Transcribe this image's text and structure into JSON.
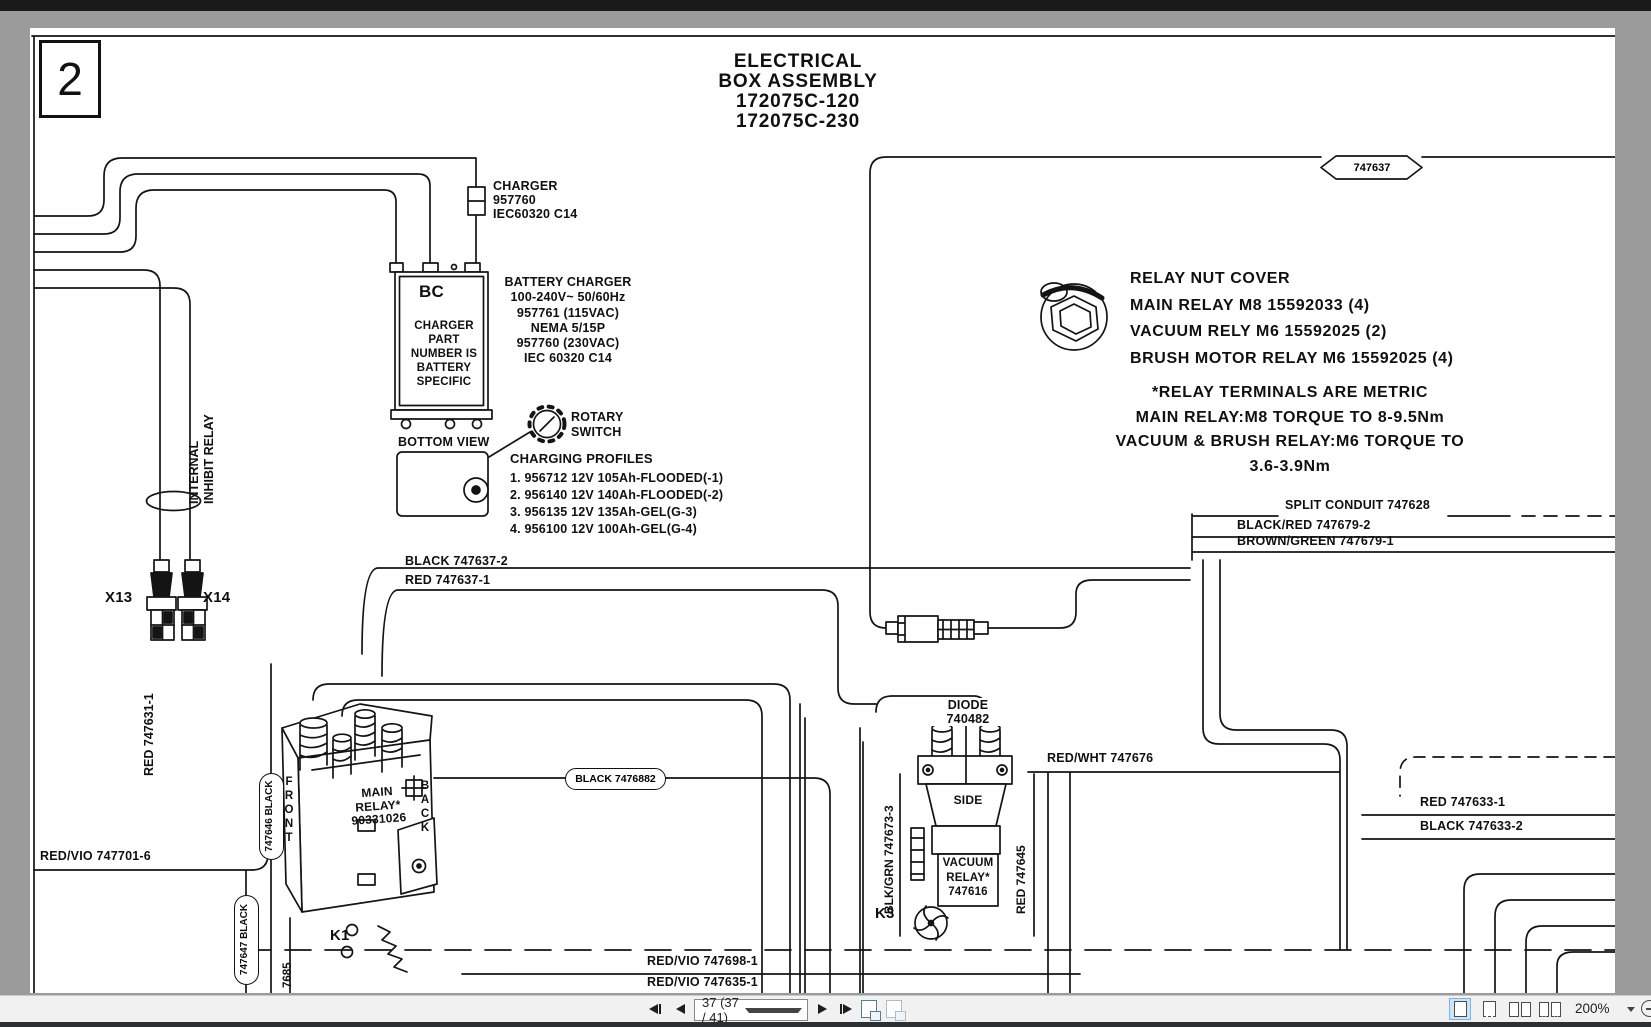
{
  "toolbar": {
    "page_field": "37 (37 / 41)",
    "zoom_level": "200%"
  },
  "diagram": {
    "sheet": "2",
    "title": [
      "ELECTRICAL",
      "BOX ASSEMBLY",
      "172075C-120",
      "172075C-230"
    ],
    "charger_fuse": [
      "CHARGER",
      "957760",
      "IEC60320 C14"
    ],
    "bc_label": "BC",
    "bc_note": [
      "CHARGER",
      "PART",
      "NUMBER IS",
      "BATTERY",
      "SPECIFIC"
    ],
    "battery_charger": [
      "BATTERY CHARGER",
      "100-240V~ 50/60Hz",
      "957761 (115VAC)",
      "NEMA 5/15P",
      "957760 (230VAC)",
      "IEC 60320 C14"
    ],
    "bottom_view": "BOTTOM VIEW",
    "rotary": [
      "ROTARY",
      "SWITCH"
    ],
    "profiles_title": "CHARGING PROFILES",
    "profiles": [
      "1.  956712  12V  105Ah-FLOODED(-1)",
      "2.  956140  12V  140Ah-FLOODED(-2)",
      "3.  956135  12V  135Ah-GEL(G-3)",
      "4.  956100  12V  100Ah-GEL(G-4)"
    ],
    "nut_cover": [
      "RELAY  NUT  COVER",
      "MAIN  RELAY  M8  15592033  (4)",
      "VACUUM  RELY  M6  15592025  (2)",
      "BRUSH  MOTOR  RELAY  M6  15592025  (4)"
    ],
    "torque_note": [
      "*RELAY  TERMINALS  ARE  METRIC",
      "MAIN  RELAY:M8  TORQUE  TO  8-9.5Nm",
      "VACUUM  &  BRUSH  RELAY:M6  TORQUE  TO",
      "3.6-3.9Nm"
    ],
    "split_conduit": "SPLIT  CONDUIT  747628",
    "black_red": "BLACK/RED  747679-2",
    "brown_green": "BROWN/GREEN  747679-1",
    "wire_747637": "747637",
    "inhibit": [
      "INTERNAL",
      "INHIBIT  RELAY"
    ],
    "x13": "X13",
    "x14": "X14",
    "red_747631": "RED  747631-1",
    "black_747637_2": "BLACK  747637-2",
    "red_747637_1": "RED  747637-1",
    "red_vio_747701": "RED/VIO  747701-6",
    "oval_747646": "747646 BLACK",
    "oval_747647": "747647 BLACK",
    "wire_7685": "7685",
    "main_relay": [
      "MAIN",
      "RELAY*",
      "90331026"
    ],
    "front": "FRONT",
    "back": "BACK",
    "k1": "K1",
    "oval_7476882": "BLACK 7476882",
    "diode": [
      "DIODE",
      "740482"
    ],
    "side": "SIDE",
    "vacuum_relay": [
      "VACUUM",
      "RELAY*",
      "747616"
    ],
    "k3": "K3",
    "blk_grn": "BLK/GRN  747673-3",
    "red_747645": "RED  747645",
    "red_wht": "RED/WHT  747676",
    "red_747633_1": "RED  747633-1",
    "black_747633_2": "BLACK  747633-2",
    "red_vio_747698": "RED/VIO  747698-1",
    "red_vio_747635": "RED/VIO  747635-1"
  }
}
